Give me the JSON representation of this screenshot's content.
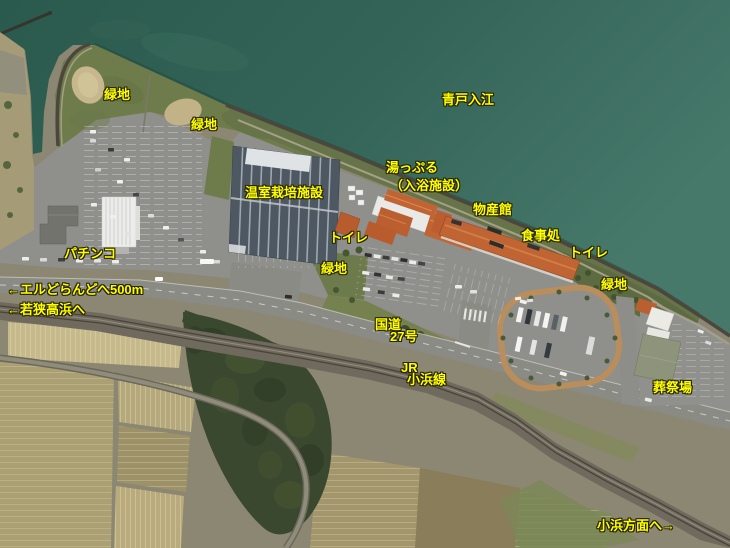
{
  "canvas": {
    "width": 730,
    "height": 548
  },
  "colors": {
    "water": "#2f6153",
    "grass": "#6e7b4b",
    "field_light": "#c6b98c",
    "parking": "#8f8f8b",
    "road": "#8b8b86",
    "rail": "#6f6a5d",
    "forest": "#3a4830",
    "roof_orange": "#c06434",
    "roof_white": "#e9e9e7",
    "greenhouse": "#4e5862",
    "label_text": "#ffff00",
    "label_outline": "#262300"
  },
  "map_labels": [
    {
      "id": "ryokuchi-nw",
      "text": "緑地",
      "x": 104,
      "y": 88
    },
    {
      "id": "ryokuchi-n",
      "text": "緑地",
      "x": 191,
      "y": 118
    },
    {
      "id": "aoto-irie",
      "text": "青戸入江",
      "x": 442,
      "y": 93
    },
    {
      "id": "yuppuru-line1",
      "text": "湯っぷる",
      "x": 386,
      "y": 161
    },
    {
      "id": "yuppuru-line2",
      "text": "（入浴施設）",
      "x": 390,
      "y": 179
    },
    {
      "id": "onshitsu-saibai",
      "text": "温室栽培施設",
      "x": 245,
      "y": 186
    },
    {
      "id": "bussankan",
      "text": "物産館",
      "x": 473,
      "y": 203
    },
    {
      "id": "shokujidokoro",
      "text": "食事処",
      "x": 521,
      "y": 229
    },
    {
      "id": "toilet-west",
      "text": "トイレ",
      "x": 329,
      "y": 231
    },
    {
      "id": "toilet-east",
      "text": "トイレ",
      "x": 569,
      "y": 246
    },
    {
      "id": "pachinko",
      "text": "パチンコ",
      "x": 64,
      "y": 247
    },
    {
      "id": "ryokuchi-center",
      "text": "緑地",
      "x": 321,
      "y": 262
    },
    {
      "id": "ryokuchi-e",
      "text": "緑地",
      "x": 601,
      "y": 278
    },
    {
      "id": "eldorando",
      "text": "←エルどらんどへ500m",
      "x": 7,
      "y": 283
    },
    {
      "id": "wakasa-takahama",
      "text": "←若狭高浜へ",
      "x": 7,
      "y": 303
    },
    {
      "id": "kokudo",
      "text": "国道",
      "x": 375,
      "y": 318
    },
    {
      "id": "kokudo-27",
      "text": "27号",
      "x": 390,
      "y": 330
    },
    {
      "id": "jr",
      "text": "JR",
      "x": 401,
      "y": 361
    },
    {
      "id": "obama-line",
      "text": "小浜線",
      "x": 407,
      "y": 373
    },
    {
      "id": "sosaijo",
      "text": "葬祭場",
      "x": 653,
      "y": 381
    },
    {
      "id": "obama-houmen",
      "text": "小浜方面へ→",
      "x": 597,
      "y": 519
    }
  ]
}
